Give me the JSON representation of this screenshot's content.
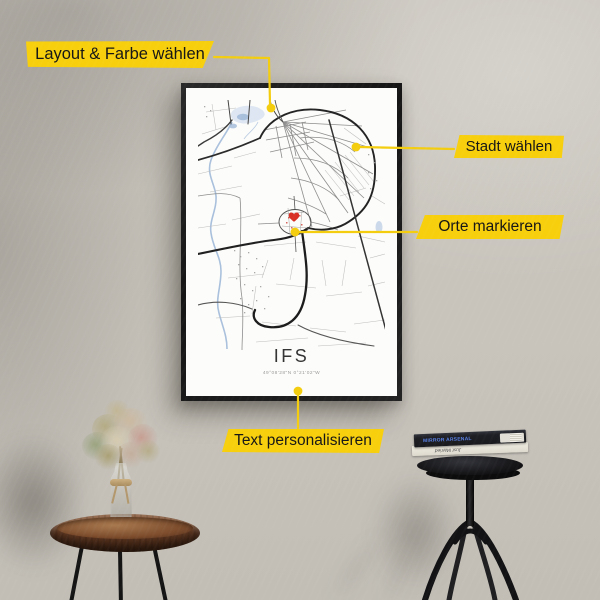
{
  "callouts": {
    "layout": {
      "label": "Layout & Farbe wählen"
    },
    "city": {
      "label": "Stadt wählen"
    },
    "places": {
      "label": "Orte markieren"
    },
    "personalize": {
      "label": "Text personalisieren"
    }
  },
  "poster": {
    "title": "IFS",
    "coordinates": "49°08'28\"N 0°21'02\"W"
  },
  "books": {
    "top_spine": "MIRROR ARSENAL",
    "bottom_spine": "Just Married"
  },
  "colors": {
    "callout_yellow": "#F7CF0C",
    "heart_red": "#D93025",
    "water_blue": "#A9C0DC",
    "frame_black": "#1C1C1C",
    "wall_gray": "#C8C4BC"
  }
}
